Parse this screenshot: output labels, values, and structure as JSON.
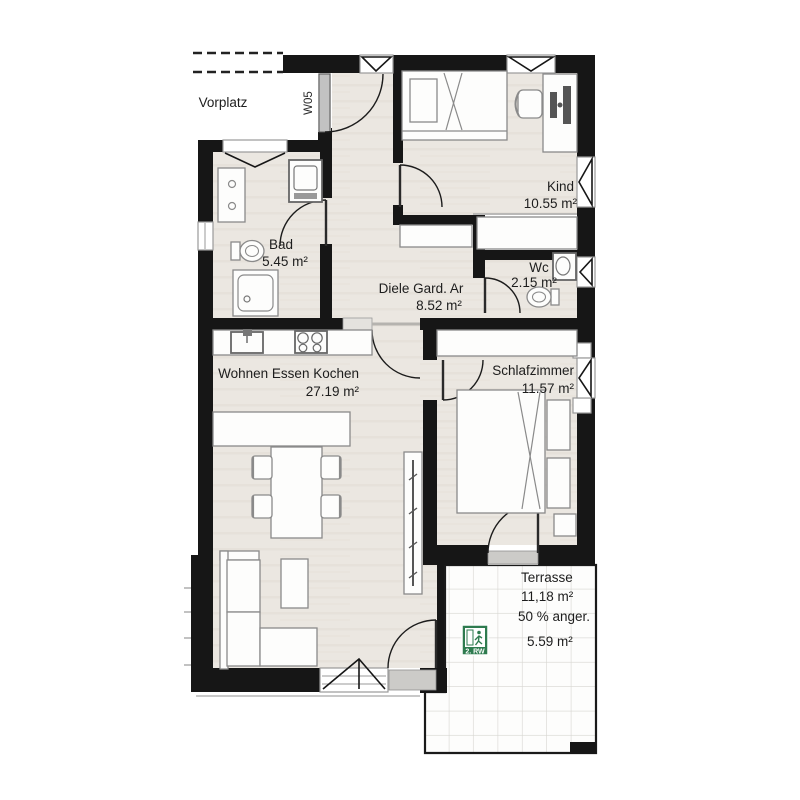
{
  "plan": {
    "outside_area_label": "Vorplatz",
    "unit_door_label": "W05",
    "rooms": [
      {
        "name": "Kind",
        "area": "10.55 m²"
      },
      {
        "name": "Bad",
        "area": "5.45 m²"
      },
      {
        "name": "Wc",
        "area": "2.15 m²"
      },
      {
        "name": "Diele Gard. Ar",
        "area": "8.52 m²"
      },
      {
        "name": "Wohnen Essen Kochen",
        "area": "27.19 m²"
      },
      {
        "name": "Schlafzimmer",
        "area": "11.57 m²"
      },
      {
        "name": "Terrasse",
        "area": "11,18 m²",
        "note": "50 % anger.",
        "counted_area": "5.59 m²"
      }
    ],
    "rescue_sign": {
      "label": "2. RW",
      "green": "#2e7b4f"
    },
    "colors": {
      "wall": "#161616",
      "floor": "#ebe7e1",
      "terrace_grid": "#d7d6d1"
    }
  }
}
